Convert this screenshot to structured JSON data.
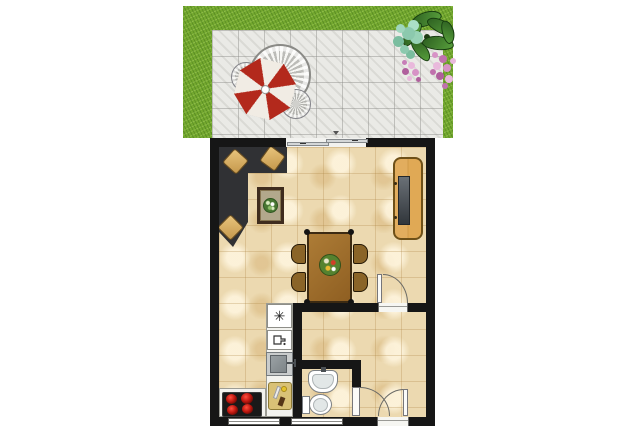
{
  "meta": {
    "type": "floor-plan-illustration",
    "view": "top-down",
    "description": "One-room apartment floor plan with garden terrace above"
  },
  "palette": {
    "background": "#ffffff",
    "grass": "#74a82f",
    "patio": "#eaeae6",
    "wall": "#161616",
    "floor": "#ecd9b0",
    "sofa": "#303134",
    "cushion": "#ddb369",
    "wood_cabinet": "#dcaa5c",
    "wood_table": "#a5742f",
    "wood_chair": "#8a6428",
    "umbrella_red": "#b3291c",
    "umbrella_white": "#f1ece4",
    "counter": "#f3f3ef",
    "stove": "#191919",
    "burner": "#c01810",
    "fixture": "#ffffff",
    "plant_green": "#3f7a30",
    "flower_pink": "#d792c6",
    "bush_teal": "#9fd6bd"
  },
  "glyphs": {
    "freezer": "✳"
  },
  "scene": {
    "garden": [
      "lawn",
      "paved patio",
      "round patio table",
      "patio chair",
      "patio chair",
      "red-white parasol",
      "leafy plant",
      "teal shrub",
      "pink flowers"
    ],
    "living_area": [
      "corner sofa",
      "sofa cushions",
      "coffee table with plant",
      "tv sideboard",
      "dining table",
      "four dining chairs",
      "table centerpiece"
    ],
    "kitchen": [
      "freezer",
      "refrigerator",
      "sink",
      "cutting board with knife",
      "stove with four burners",
      "counters"
    ],
    "bathroom": [
      "washbasin",
      "toilet"
    ],
    "openings": [
      "sliding terrace door",
      "living room door",
      "bathroom door",
      "entrance door",
      "window",
      "window"
    ]
  }
}
